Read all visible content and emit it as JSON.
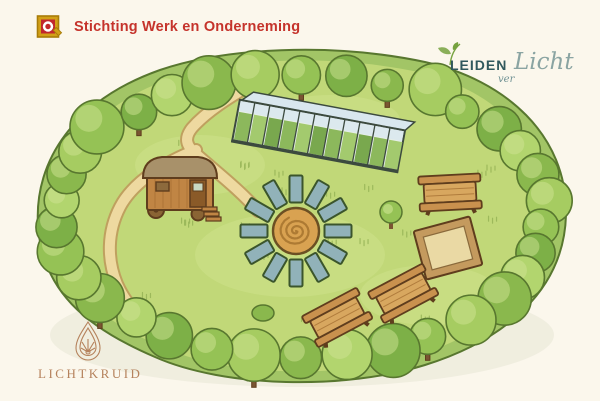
{
  "branding": {
    "swo": {
      "name": "Stichting Werk en Onderneming",
      "text_color": "#c5332b",
      "icon": {
        "name": "swo-logo-icon",
        "gold": "#d2a017",
        "gold_dark": "#a87c08",
        "red": "#c1272d",
        "white": "#ffffff"
      }
    },
    "leidenverlicht": {
      "word1": "LEIDEN",
      "word2": "ver",
      "word3": "Licht",
      "caps_color": "#30585c",
      "script_color": "#6f9193",
      "script_color2": "#8aa4a2",
      "leaf_color": "#76a23f",
      "icon": "leaf-sprig-icon"
    },
    "lichtkruid": {
      "name": "LICHTKRUID",
      "color": "#b5825c",
      "icon": "botanical-drop-icon"
    }
  },
  "illustration": {
    "description": "watercolor site map of a community garden ringed by trees",
    "features": [
      {
        "id": "tree-border",
        "label": "tree and hedge border"
      },
      {
        "id": "footpath",
        "label": "winding footpath with fork"
      },
      {
        "id": "greenhouse",
        "label": "glass greenhouse with plant rows",
        "panels": 11
      },
      {
        "id": "wagon",
        "label": "wooden caravan with steps"
      },
      {
        "id": "spiral-circle",
        "label": "central spiral sand circle"
      },
      {
        "id": "garden-beds",
        "label": "radiating rectangular garden beds",
        "count": 12
      },
      {
        "id": "picnic-tables",
        "label": "picnic tables",
        "count": 3
      },
      {
        "id": "sandbox",
        "label": "square sandbox"
      },
      {
        "id": "small-tree",
        "label": "small tree beside beds"
      },
      {
        "id": "bush",
        "label": "round bush"
      }
    ],
    "palette": {
      "background": "#fbf7ec",
      "shadow": "#e2e3d1",
      "hedge": "#a2c566",
      "grass": "#c1d878",
      "grass_light": "#d3e592",
      "grass_mark": "#93b254",
      "outline": "#58772f",
      "tree1": "#8ab84d",
      "tree2": "#a6cc61",
      "tree3": "#95c255",
      "tree4": "#7db047",
      "tree5": "#b2d56e",
      "tree_light": "#cfe493",
      "trunk": "#7a5532",
      "path_fill": "#eed9a0",
      "path_edge": "#bfa05f",
      "bed_fill": "#91b2b9",
      "bed_stroke": "#3b552c",
      "spiral_fill": "#d9a251",
      "spiral_line": "#ad7a33",
      "spiral_stroke": "#6b4f23",
      "wood": "#c9914e",
      "wood_light": "#d8a75f",
      "wood_dark": "#a06a2e",
      "wood_outline": "#5f3d1d",
      "sand": "#ead9a4",
      "sand_frame": "#c49a5e",
      "glass": "#e6eee9",
      "glass_sky": "#d9e7ee",
      "frame": "#3c4a3e",
      "plant1": "#8cb85c",
      "plant2": "#a3ca6e",
      "plant3": "#79a84e",
      "roof": "#a8916a",
      "wagon_body": "#c08544",
      "wagon_dark": "#8a5a28"
    }
  }
}
